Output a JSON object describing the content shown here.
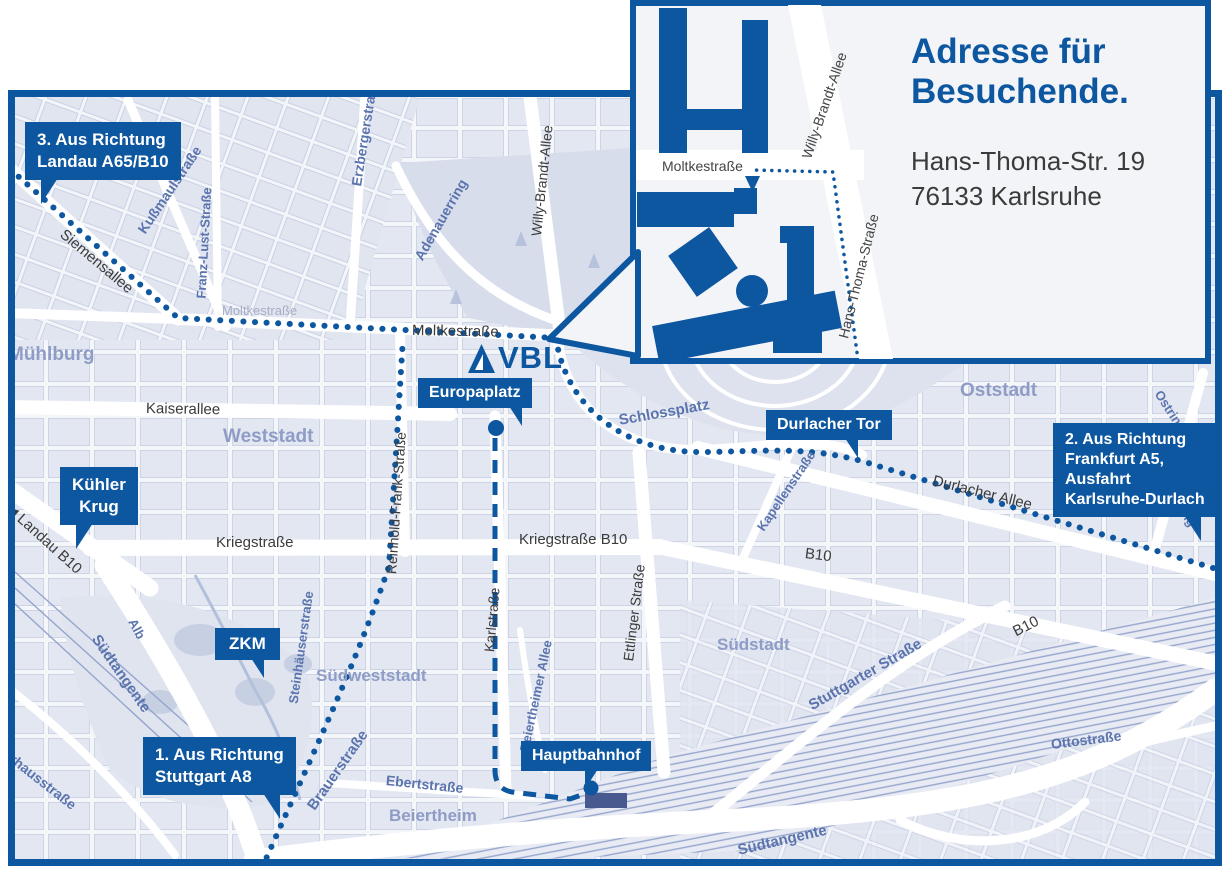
{
  "colors": {
    "accent": "#0d56a0",
    "street_blue": "#5b74ae",
    "district": "#8e9cc6"
  },
  "logo": {
    "text": "VBL"
  },
  "inset": {
    "title": {
      "line1": "Adresse für",
      "line2": "Besuchende."
    },
    "address": {
      "line1": "Hans-Thoma-Str. 19",
      "line2": "76133 Karlsruhe"
    },
    "labels": {
      "moltkestrasse": "Moltkestraße",
      "willy_brandt_allee": "Willy-Brandt-Allee",
      "hans_thoma_strasse": "Hans-Thoma-Straße"
    }
  },
  "badges": {
    "route3": {
      "line1": "3. Aus Richtung",
      "line2": "Landau A65/B10"
    },
    "route1": {
      "line1": "1. Aus Richtung",
      "line2": "Stuttgart A8"
    },
    "route2": {
      "line1": "2. Aus Richtung",
      "line2": "Frankfurt A5,",
      "line3": "Ausfahrt",
      "line4": "Karlsruhe-Durlach"
    },
    "kuehler_krug": {
      "line1": "Kühler",
      "line2": "Krug"
    },
    "zkm": {
      "label": "ZKM"
    },
    "europaplatz": {
      "label": "Europaplatz"
    },
    "durlacher_tor": {
      "label": "Durlacher Tor"
    },
    "hauptbahnhof": {
      "label": "Hauptbahnhof"
    }
  },
  "labels": {
    "muehlburg": "Mühlburg",
    "weststadt": "Weststadt",
    "oststadt": "Oststadt",
    "suedstadt": "Südstadt",
    "suedweststadt": "Südweststadt",
    "beiertheim": "Beiertheim",
    "siemensallee": "Siemensallee",
    "kussmaulstrasse": "Kußmaulstraße",
    "franz_lust_strasse": "Franz-Lust-Straße",
    "erzbergerstrasse": "Erzbergerstraße",
    "adenauerring": "Adenauerring",
    "willy_brandt_allee": "Willy-Brandt-Allee",
    "moltkestrasse": "Moltkestraße",
    "moltkestrasse_faint": "Moltkestraße",
    "kaiserallee": "Kaiserallee",
    "reinhold_frank_strasse": "Reinhold-Frank-Straße",
    "kriegstrasse": "Kriegstraße",
    "kriegstrasse_b10": "Kriegstraße B10",
    "karlstrasse": "Karlstraße",
    "ettlinger_strasse": "Ettlinger Straße",
    "schlossplatz": "Schlossplatz",
    "kapellenstrasse": "Kapellenstraße",
    "durlacher_allee": "Durlacher Allee",
    "b10_mid": "B10",
    "b10_east": "B10",
    "ostring_north": "Ostring",
    "ostring_south": "Ostring",
    "landau_arrow": "◀",
    "landau_b10": "Landau B10",
    "stuttgarter_strasse": "Stuttgarter Straße",
    "suedtangente_west": "Südtangente",
    "suedtangente_east": "Südtangente",
    "steinhaeuserstrasse": "Steinhäuserstraße",
    "brauerstrasse": "Brauerstraße",
    "ebertstrasse": "Ebertstraße",
    "alb": "Alb",
    "beiertheimer_allee": "Beiertheimer Allee",
    "ottostrasse": "Ottostraße",
    "pulverhausstrasse": "Pulverhausstraße"
  }
}
